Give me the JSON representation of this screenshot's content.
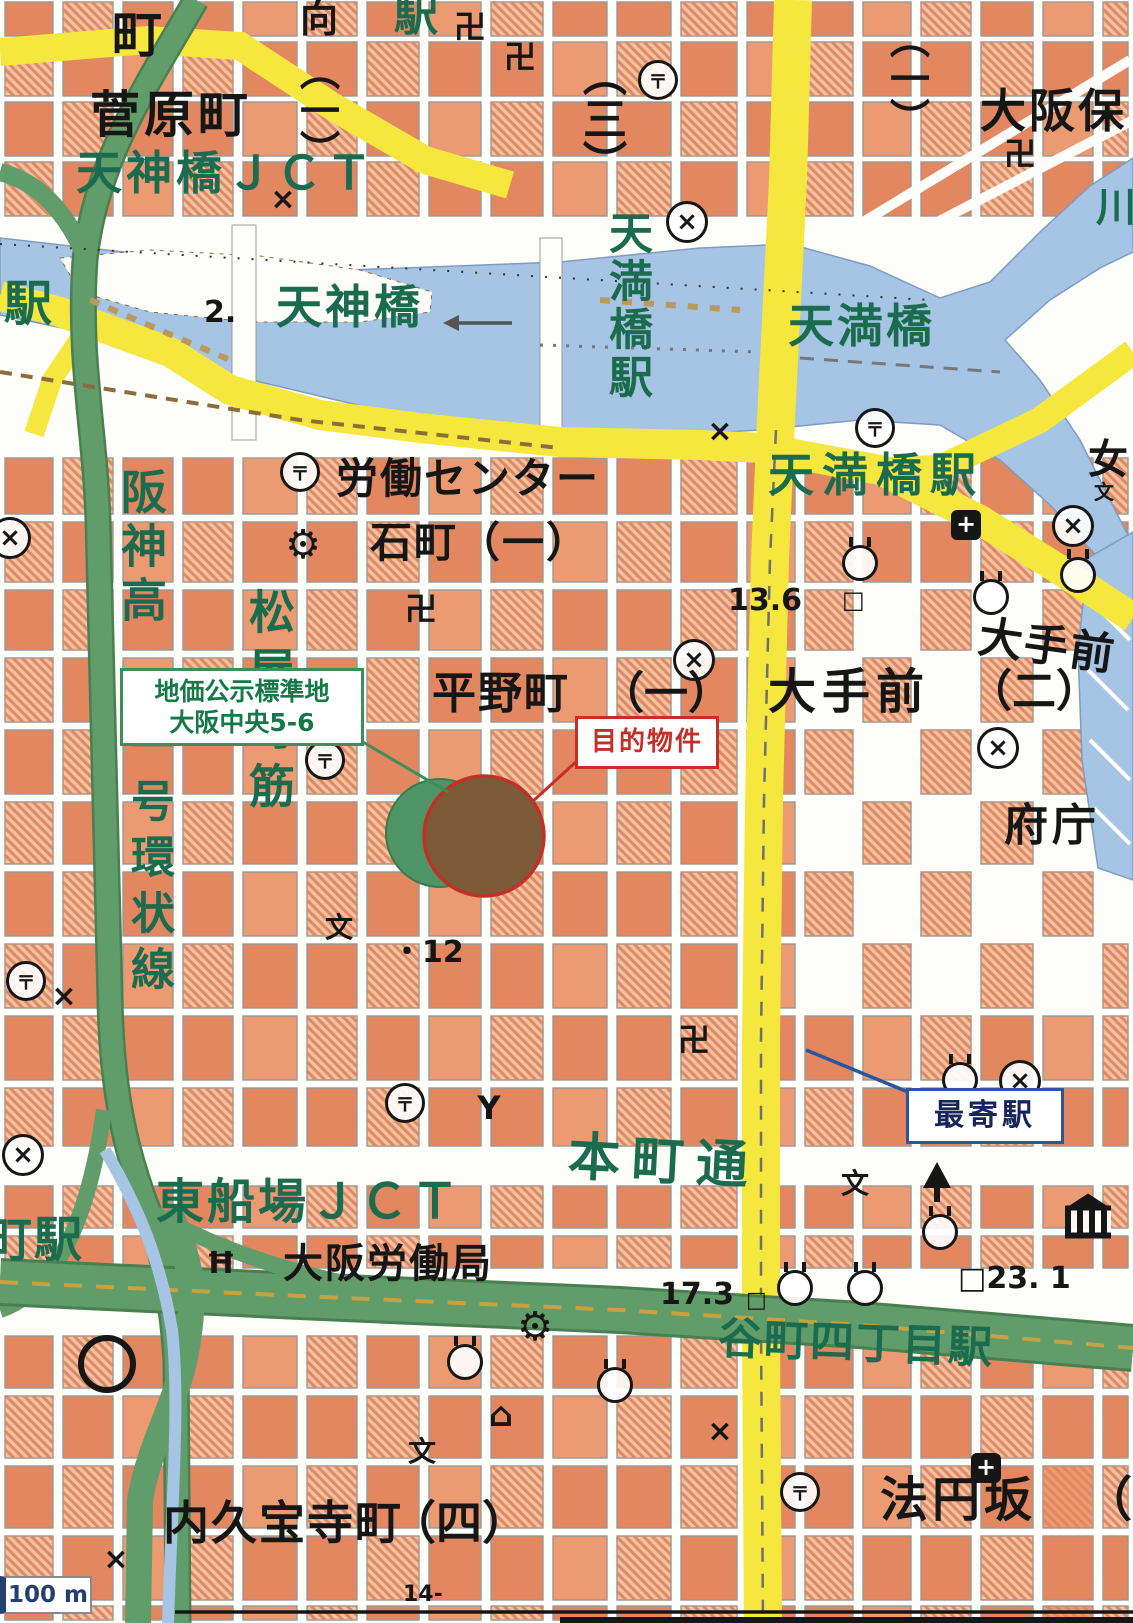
{
  "map": {
    "region": "大阪市中央区 平野町・大手前周辺",
    "colors": {
      "black_text": "#161616",
      "green_text": "#1b6b4e",
      "building_orange": "#e2875f",
      "building_orange_light": "#efc2a4",
      "water_blue": "#a6c4e4",
      "road_yellow": "#f6e73e",
      "highway_green": "#619c6b",
      "callout_green": "#3d8f58",
      "callout_red": "#c33028",
      "callout_blue": "#2b55a0"
    },
    "callouts": {
      "standard_land": {
        "line1": "地価公示標準地",
        "line2": "大阪中央5-6"
      },
      "target": {
        "label": "目的物件"
      },
      "nearest_station": {
        "label": "最寄駅"
      }
    },
    "scale_bar": {
      "label": "100 m"
    },
    "labels": [
      {
        "t": "町",
        "x": 112,
        "y": 10,
        "s": 50,
        "c": "k"
      },
      {
        "t": "向",
        "x": 300,
        "y": 0,
        "s": 38,
        "c": "k"
      },
      {
        "t": "菅原町",
        "x": 90,
        "y": 90,
        "s": 50,
        "c": "k",
        "ls": 4
      },
      {
        "t": "天神橋ＪＣＴ",
        "x": 76,
        "y": 150,
        "s": 46,
        "c": "g",
        "ls": 4
      },
      {
        "t": "（一）",
        "x": 296,
        "y": 50,
        "s": 40,
        "c": "k",
        "v": 1
      },
      {
        "t": "駅",
        "x": 394,
        "y": -6,
        "s": 44,
        "c": "g"
      },
      {
        "t": "（三）",
        "x": 578,
        "y": 52,
        "s": 44,
        "c": "k",
        "v": 1
      },
      {
        "t": "（一）",
        "x": 886,
        "y": 18,
        "s": 40,
        "c": "k",
        "v": 1
      },
      {
        "t": "大阪保",
        "x": 980,
        "y": 88,
        "s": 46,
        "c": "k",
        "ls": 3
      },
      {
        "t": "川",
        "x": 1096,
        "y": 188,
        "s": 40,
        "c": "g"
      },
      {
        "t": "駅",
        "x": 4,
        "y": 280,
        "s": 48,
        "c": "g"
      },
      {
        "t": "2.",
        "x": 204,
        "y": 298,
        "s": 30,
        "c": "k"
      },
      {
        "t": "天神橋",
        "x": 276,
        "y": 284,
        "s": 46,
        "c": "g",
        "ls": 3
      },
      {
        "t": "天満橋",
        "x": 788,
        "y": 303,
        "s": 46,
        "c": "g",
        "ls": 3
      },
      {
        "t": "天満橋駅",
        "x": 604,
        "y": 210,
        "s": 44,
        "c": "g",
        "v": 1,
        "ls": 4
      },
      {
        "t": "天満橋駅",
        "x": 768,
        "y": 452,
        "s": 46,
        "c": "g",
        "ls": 8
      },
      {
        "t": "女",
        "x": 1088,
        "y": 440,
        "s": 40,
        "c": "k"
      },
      {
        "t": "労働センター",
        "x": 336,
        "y": 458,
        "s": 42,
        "c": "k",
        "ls": 2
      },
      {
        "t": "石町（一）",
        "x": 370,
        "y": 522,
        "s": 42,
        "c": "k",
        "ls": 2
      },
      {
        "t": "阪神高",
        "x": 118,
        "y": 468,
        "s": 46,
        "c": "g",
        "v": 1,
        "ls": 8
      },
      {
        "t": "一号環状線",
        "x": 126,
        "y": 722,
        "s": 44,
        "c": "g",
        "v": 1,
        "ls": 12
      },
      {
        "t": "松屋町筋",
        "x": 246,
        "y": 588,
        "s": 46,
        "c": "g",
        "v": 1,
        "ls": 12
      },
      {
        "t": "平野町",
        "x": 432,
        "y": 672,
        "s": 44,
        "c": "k",
        "ls": 2
      },
      {
        "t": "（一）",
        "x": 600,
        "y": 672,
        "s": 44,
        "c": "k"
      },
      {
        "t": "大手前",
        "x": 768,
        "y": 668,
        "s": 48,
        "c": "k",
        "ls": 6
      },
      {
        "t": "大手前",
        "x": 978,
        "y": 625,
        "s": 44,
        "c": "k",
        "ls": 2,
        "rot": 8
      },
      {
        "t": "（二）",
        "x": 968,
        "y": 670,
        "s": 44,
        "c": "k"
      },
      {
        "t": "府庁",
        "x": 1004,
        "y": 804,
        "s": 44,
        "c": "k",
        "ls": 4
      },
      {
        "t": "13.6",
        "x": 728,
        "y": 586,
        "s": 30,
        "c": "k"
      },
      {
        "t": "□",
        "x": 842,
        "y": 588,
        "s": 24,
        "c": "k"
      },
      {
        "t": "・12",
        "x": 392,
        "y": 938,
        "s": 30,
        "c": "k"
      },
      {
        "t": "本町通",
        "x": 568,
        "y": 1136,
        "s": 52,
        "c": "g",
        "ls": 12,
        "rot": 3
      },
      {
        "t": "東船場ＪＣＴ",
        "x": 156,
        "y": 1178,
        "s": 48,
        "c": "g",
        "ls": 3
      },
      {
        "t": "大阪労働局",
        "x": 283,
        "y": 1244,
        "s": 40,
        "c": "k",
        "ls": 2
      },
      {
        "t": "17.3",
        "x": 660,
        "y": 1280,
        "s": 30,
        "c": "k"
      },
      {
        "t": "□",
        "x": 746,
        "y": 1290,
        "s": 22,
        "c": "k"
      },
      {
        "t": "□23. 1",
        "x": 958,
        "y": 1264,
        "s": 30,
        "c": "k"
      },
      {
        "t": "谷町四丁目駅",
        "x": 718,
        "y": 1322,
        "s": 44,
        "c": "g",
        "ls": 2,
        "rot": 2
      },
      {
        "t": "町駅",
        "x": -16,
        "y": 1216,
        "s": 48,
        "c": "g",
        "ls": 2
      },
      {
        "t": "内久宝寺町",
        "x": 163,
        "y": 1500,
        "s": 46,
        "c": "k",
        "ls": 2
      },
      {
        "t": "（四）",
        "x": 390,
        "y": 1500,
        "s": 46,
        "c": "k"
      },
      {
        "t": "法円坂",
        "x": 880,
        "y": 1476,
        "s": 48,
        "c": "k",
        "ls": 4
      },
      {
        "t": "（",
        "x": 1084,
        "y": 1476,
        "s": 48,
        "c": "k"
      },
      {
        "t": "14-",
        "x": 403,
        "y": 1584,
        "s": 22,
        "c": "k"
      }
    ],
    "symbols": [
      {
        "type": "post-office",
        "x": 658,
        "y": 80
      },
      {
        "type": "post-office",
        "x": 300,
        "y": 472
      },
      {
        "type": "post-office",
        "x": 875,
        "y": 428
      },
      {
        "type": "post-office",
        "x": 325,
        "y": 760
      },
      {
        "type": "post-office",
        "x": 26,
        "y": 981
      },
      {
        "type": "post-office",
        "x": 405,
        "y": 1103
      },
      {
        "type": "post-office",
        "x": 800,
        "y": 1492
      },
      {
        "type": "police-station",
        "x": 687,
        "y": 222
      },
      {
        "type": "police-station",
        "x": 694,
        "y": 660
      },
      {
        "type": "police-station",
        "x": 1020,
        "y": 1081
      },
      {
        "type": "police-station",
        "x": 23,
        "y": 1155
      },
      {
        "type": "police-station",
        "x": 1073,
        "y": 526
      },
      {
        "type": "police-station",
        "x": 998,
        "y": 748
      },
      {
        "type": "police-station",
        "x": 10,
        "y": 538
      },
      {
        "type": "temple",
        "x": 470,
        "y": 25
      },
      {
        "type": "temple",
        "x": 520,
        "y": 55
      },
      {
        "type": "temple",
        "x": 1020,
        "y": 152
      },
      {
        "type": "temple",
        "x": 421,
        "y": 607
      },
      {
        "type": "temple",
        "x": 694,
        "y": 1038
      },
      {
        "type": "shrine",
        "x": 860,
        "y": 563
      },
      {
        "type": "shrine",
        "x": 991,
        "y": 597
      },
      {
        "type": "shrine",
        "x": 1078,
        "y": 575
      },
      {
        "type": "shrine",
        "x": 960,
        "y": 1080
      },
      {
        "type": "shrine",
        "x": 940,
        "y": 1232
      },
      {
        "type": "shrine",
        "x": 795,
        "y": 1288
      },
      {
        "type": "shrine",
        "x": 865,
        "y": 1288
      },
      {
        "type": "shrine",
        "x": 615,
        "y": 1385
      },
      {
        "type": "shrine",
        "x": 465,
        "y": 1362
      },
      {
        "type": "tower",
        "x": 937,
        "y": 1175
      },
      {
        "type": "school",
        "x": 339,
        "y": 926
      },
      {
        "type": "school",
        "x": 855,
        "y": 1182
      },
      {
        "type": "school",
        "x": 422,
        "y": 1450
      },
      {
        "type": "school",
        "x": 1104,
        "y": 490,
        "small": 1
      },
      {
        "type": "hospital",
        "x": 966,
        "y": 525
      },
      {
        "type": "hospital",
        "x": 986,
        "y": 1468
      },
      {
        "type": "fire-station",
        "x": 489,
        "y": 1108
      },
      {
        "type": "courthouse",
        "x": 221,
        "y": 1263
      },
      {
        "type": "museum",
        "x": 1088,
        "y": 1222
      },
      {
        "type": "factory",
        "x": 303,
        "y": 545
      },
      {
        "type": "factory",
        "x": 535,
        "y": 1327
      },
      {
        "type": "house",
        "x": 501,
        "y": 1415
      },
      {
        "type": "landmark-ring",
        "x": 107,
        "y": 1364
      },
      {
        "type": "koban",
        "x": 283,
        "y": 200
      },
      {
        "type": "koban",
        "x": 720,
        "y": 432
      },
      {
        "type": "koban",
        "x": 64,
        "y": 997
      },
      {
        "type": "koban",
        "x": 116,
        "y": 1560
      },
      {
        "type": "koban",
        "x": 720,
        "y": 1432
      }
    ]
  }
}
